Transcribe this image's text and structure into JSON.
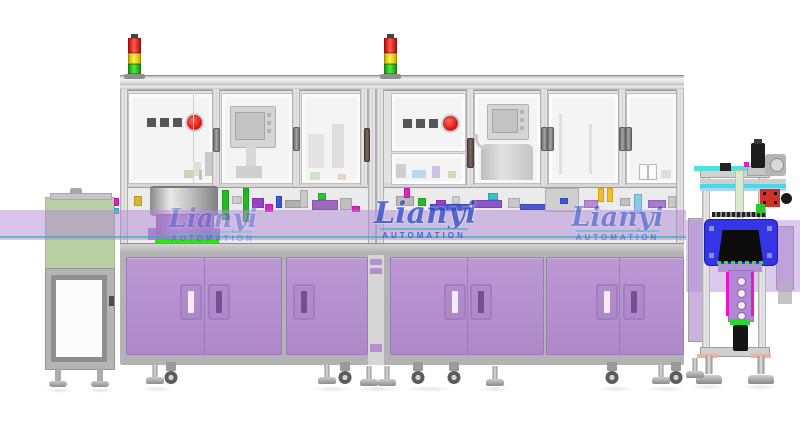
{
  "watermark": {
    "brand": "Lianyi",
    "subtitle": "AUTOMATION"
  },
  "signal_tower": {
    "lights": [
      "red",
      "yellow",
      "green"
    ]
  },
  "colors": {
    "cabinet_purple": "#b48fd0",
    "guard_band_purple": "rgba(177,137,215,0.50)",
    "infeed_oven_green": "#b9cfa4",
    "inspection_unit_blue": "#3535e8",
    "tower_red": "#e8201a",
    "tower_yellow": "#f2de20",
    "tower_green": "#35c818",
    "red_button": "#e01212",
    "rail_cyan": "#49d8e8",
    "led_strip_green": "#2de60f",
    "accent_magenta": "#e020c0",
    "watermark_blue": "#3050c8",
    "frame_gray": "#d2d2d2"
  }
}
